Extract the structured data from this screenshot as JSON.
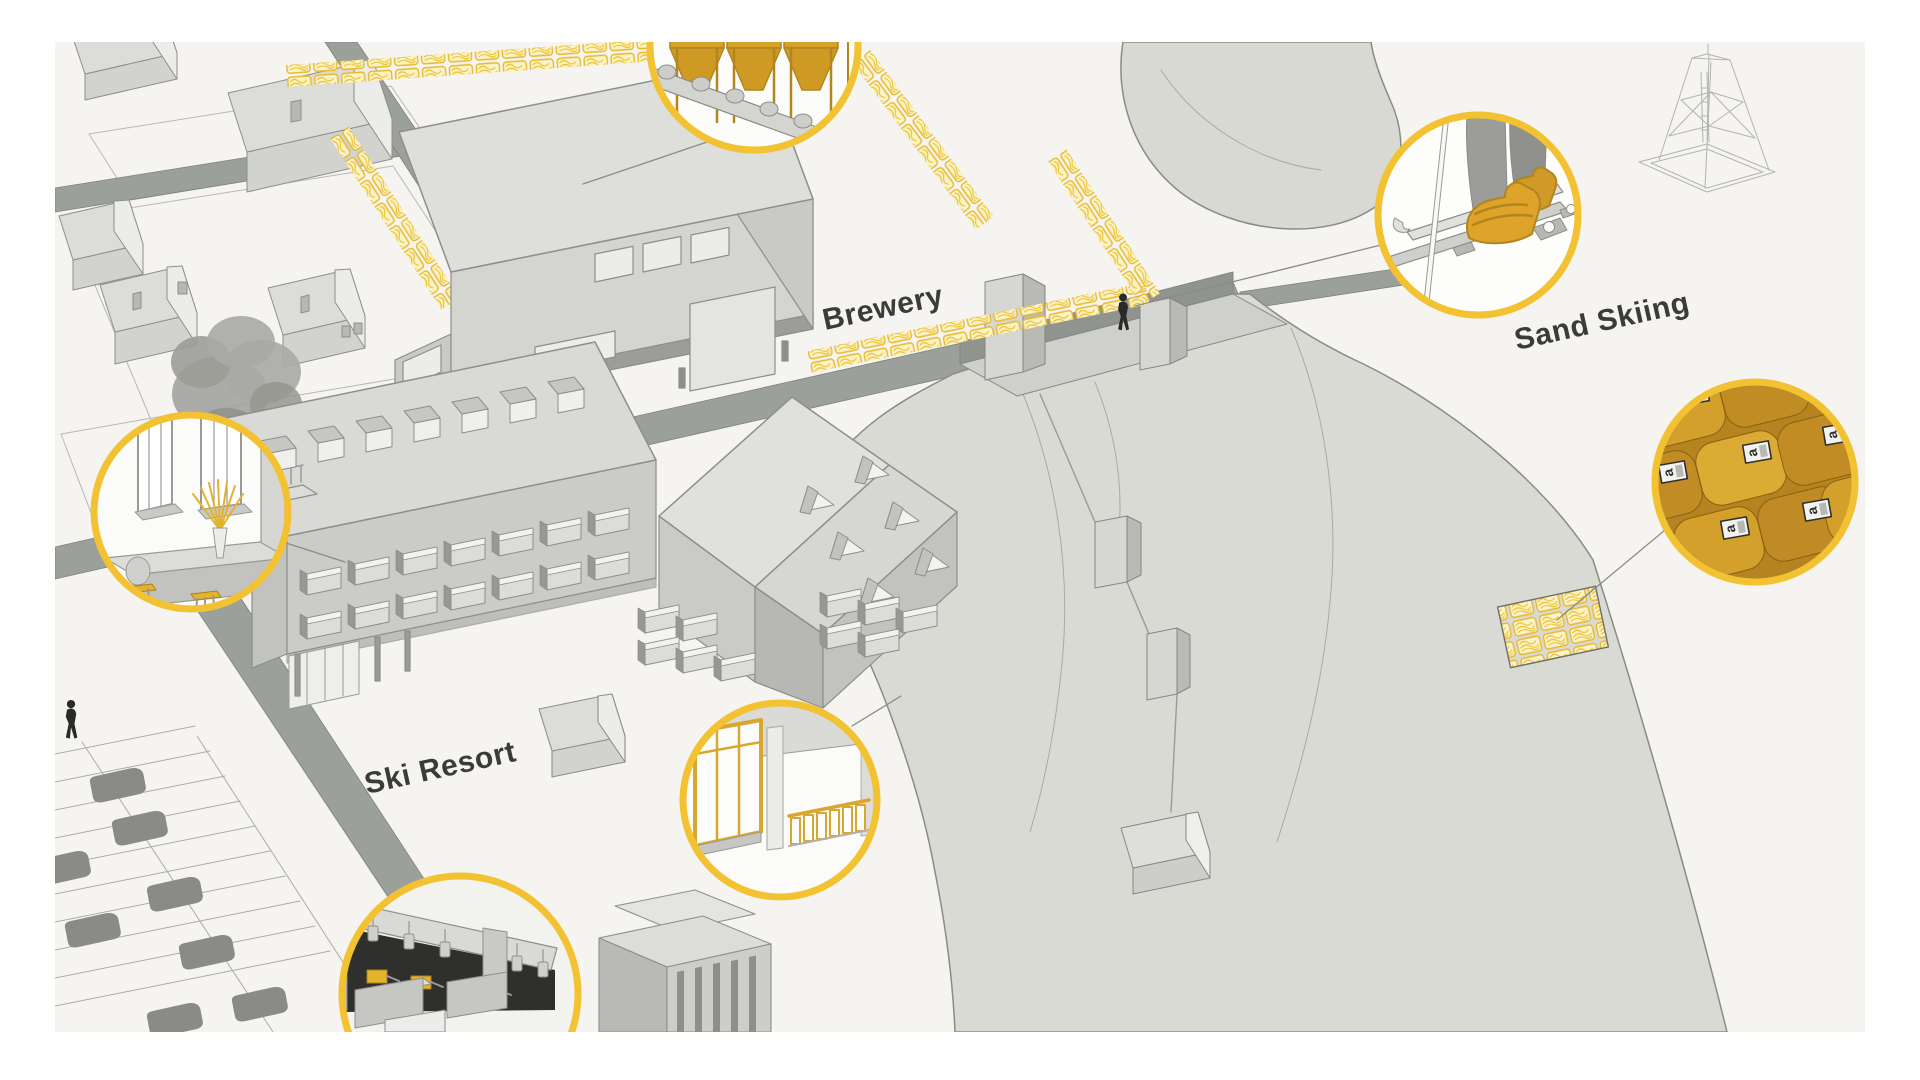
{
  "illustration": {
    "kind": "axonometric resort site illustration",
    "frame_bg": "#ffffff",
    "canvas_bg": "#f5f4f1",
    "labels": {
      "brewery": "Brewery",
      "ski_resort": "Ski Resort",
      "sand_skiing": "Sand Skiing"
    },
    "detail_tags": {
      "letter": "a"
    },
    "callouts": {
      "brewery_tanks": "brewery-fermentation-tanks-detail",
      "cafe_bar": "cafe-bar-interior-detail",
      "terrace_windows": "terrace-yellow-windows-detail",
      "night_bar": "dark-bar-interior-detail",
      "ski_boots": "sand-ski-boots-detail",
      "straw_bales": "straw-bale-stack-detail"
    },
    "colors": {
      "accent_ring": "#f2c232",
      "hay_yellow": "#e7b92b",
      "gold": "#d7a028",
      "gold_dark": "#c8922b",
      "road": "#9ba09b",
      "building_light": "#dededa",
      "building_mid": "#cfcfcb",
      "building_dark": "#b0b0ac",
      "outline": "#8e8e8a",
      "sand_slope": "#d9d9d4",
      "dark_interior": "#2f2f2d",
      "label_text": "#3b3b3b",
      "car": "#8a8a86",
      "figure": "#2a2a2a"
    }
  }
}
